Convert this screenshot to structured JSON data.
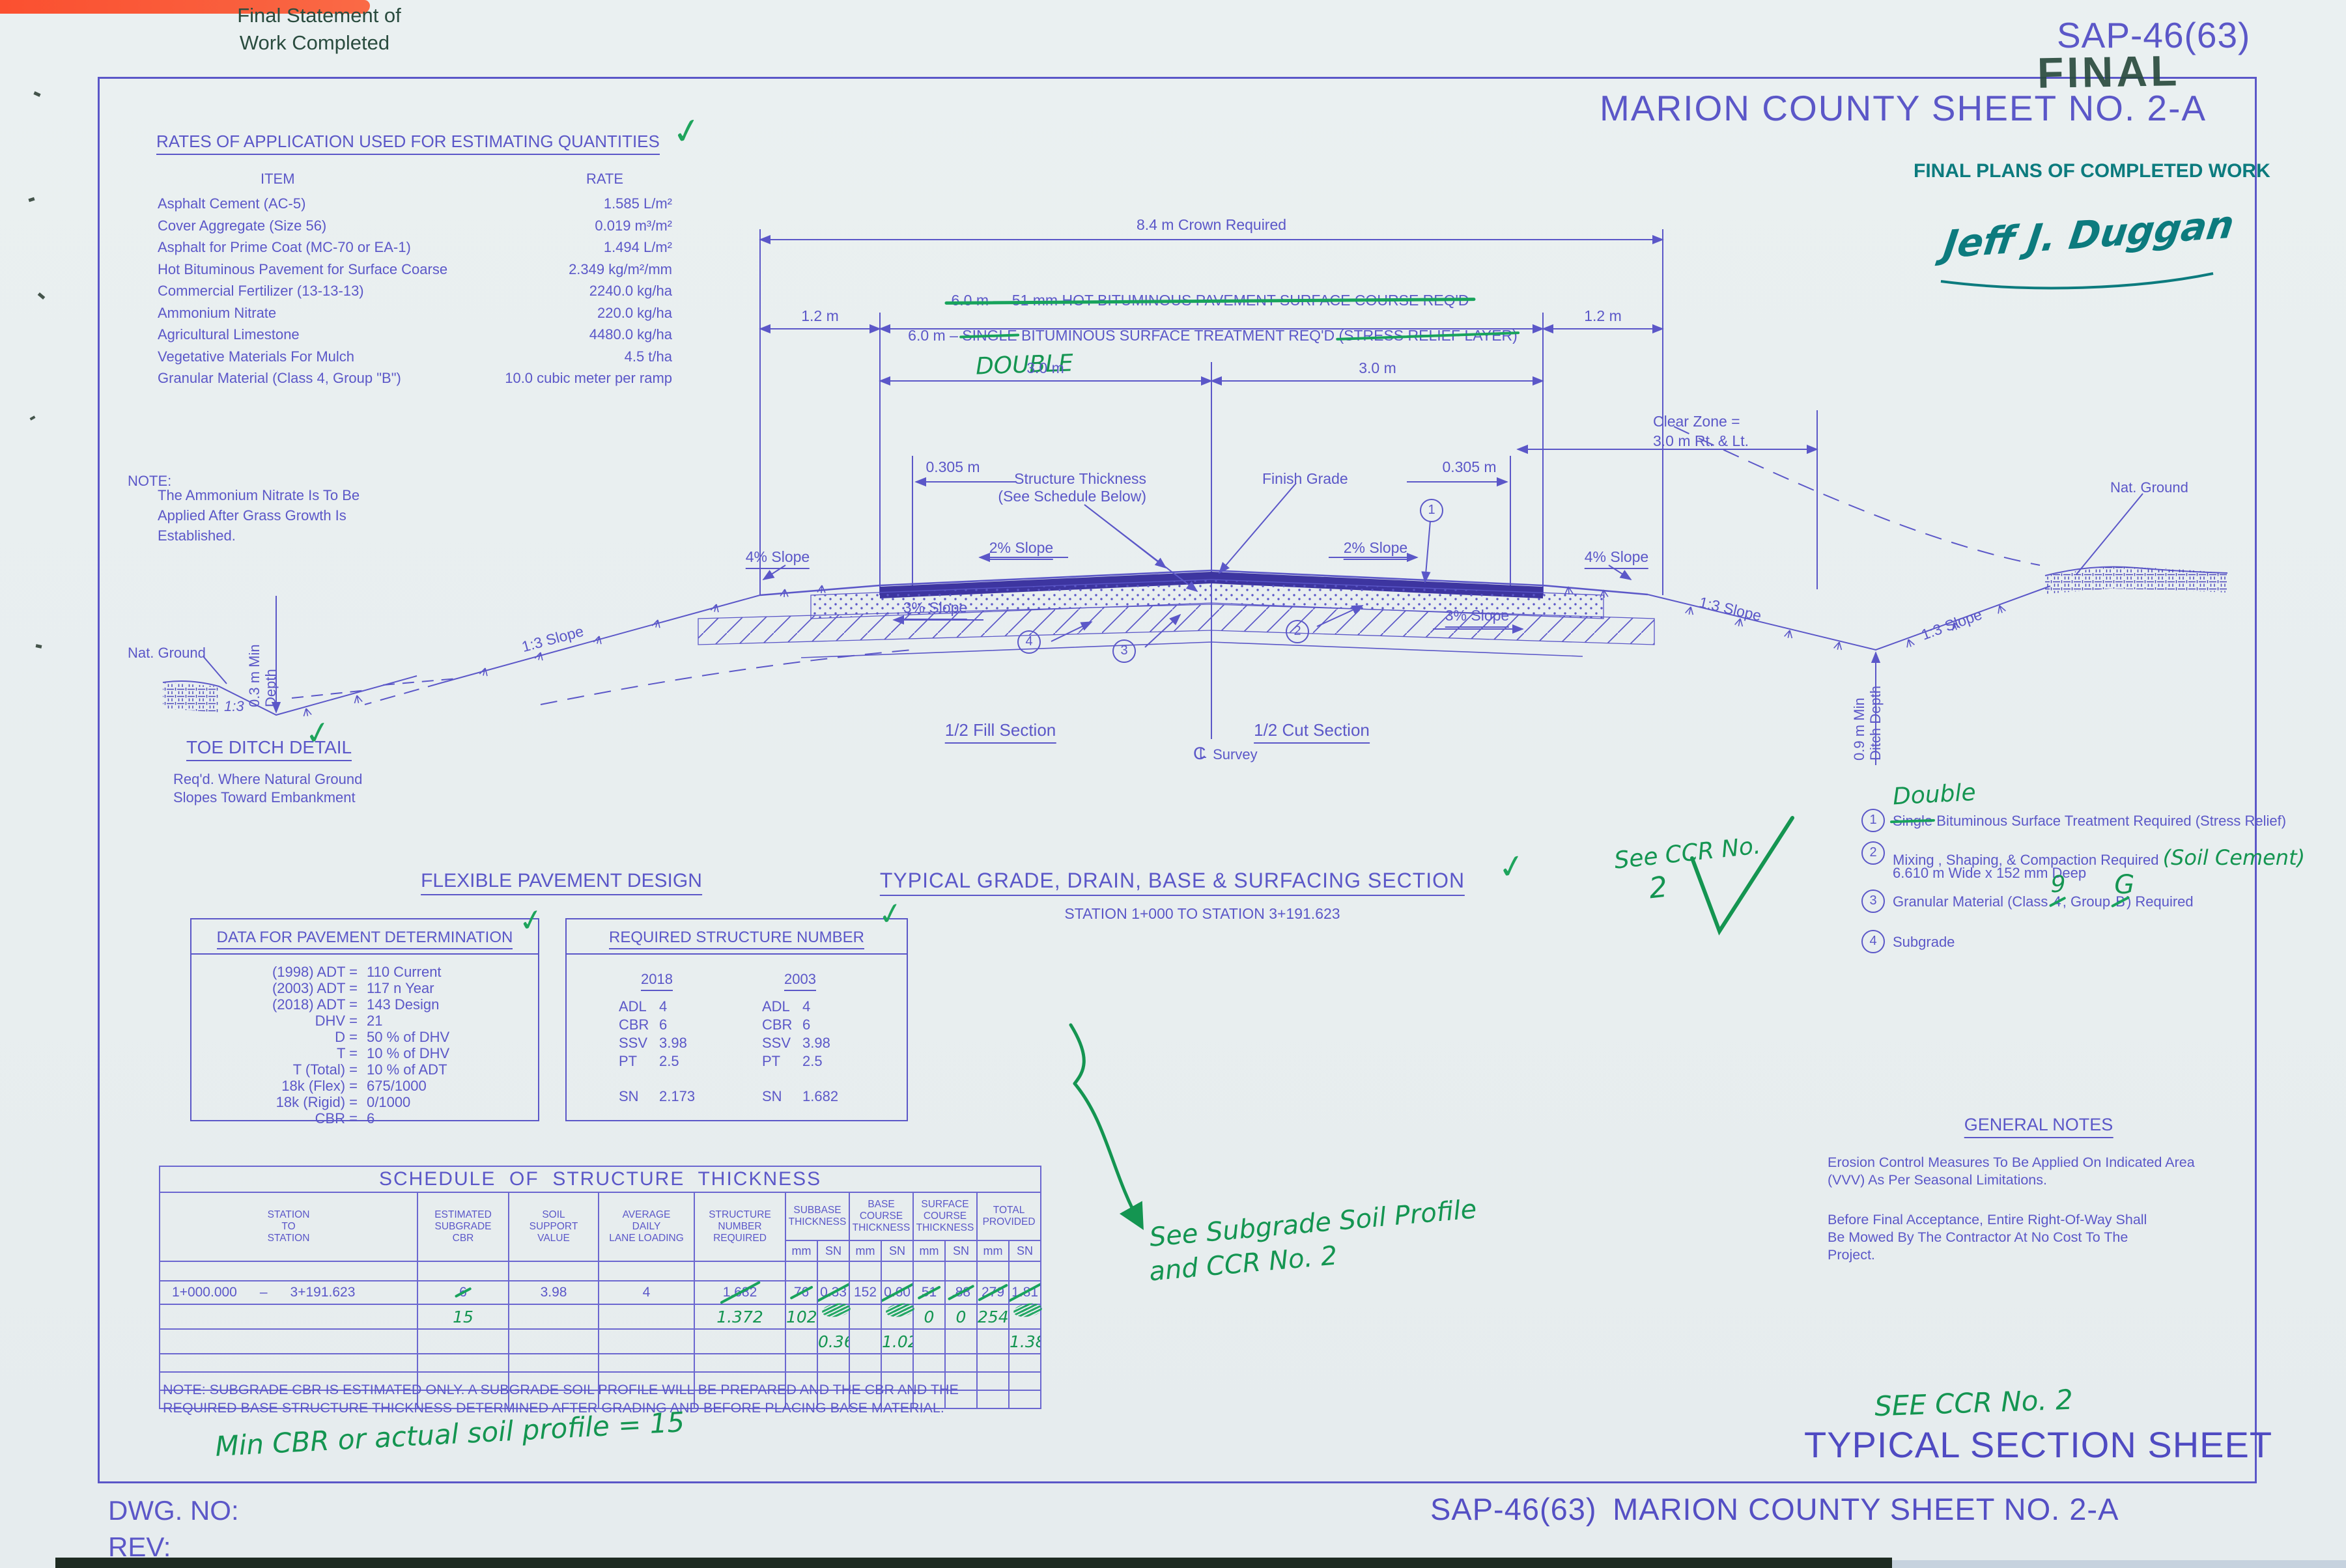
{
  "misc": {
    "check": "✓"
  },
  "header": {
    "stamp_line1": "Final Statement of",
    "stamp_line2": "Work Completed",
    "project_no": "SAP-46(63)",
    "final_stamp": "FINAL",
    "county_title": "MARION  COUNTY  SHEET NO. 2-A",
    "final_plans": "FINAL PLANS OF COMPLETED WORK",
    "signature": "Jeff J. Duggan"
  },
  "rates": {
    "heading": "RATES OF APPLICATION USED FOR ESTIMATING QUANTITIES",
    "col_item": "ITEM",
    "col_rate": "RATE",
    "rows": [
      {
        "item": "Asphalt Cement (AC-5)",
        "rate": "1.585 L/m²"
      },
      {
        "item": "Cover Aggregate (Size 56)",
        "rate": "0.019 m³/m²"
      },
      {
        "item": "Asphalt for Prime Coat (MC-70 or EA-1)",
        "rate": "1.494 L/m²"
      },
      {
        "item": "Hot Bituminous Pavement for Surface Coarse",
        "rate": "2.349 kg/m²/mm"
      },
      {
        "item": "Commercial Fertilizer (13-13-13)",
        "rate": "2240.0 kg/ha"
      },
      {
        "item": "Ammonium Nitrate",
        "rate": "220.0 kg/ha"
      },
      {
        "item": "Agricultural Limestone",
        "rate": "4480.0 kg/ha"
      },
      {
        "item": "Vegetative Materials For Mulch",
        "rate": "4.5 t/ha"
      },
      {
        "item": "Granular Material (Class 4, Group \"B\")",
        "rate": "10.0 cubic meter per ramp"
      }
    ]
  },
  "note": {
    "label": "NOTE:",
    "line1": "The Ammonium Nitrate Is To Be",
    "line2": "Applied After Grass Growth Is",
    "line3": "Established."
  },
  "toe": {
    "nat_ground": "Nat.  Ground",
    "ratio": "1:3",
    "depth1": "0.3 m  Min",
    "depth2": "Depth",
    "title": "TOE DITCH DETAIL",
    "cap1": "Req'd. Where Natural  Ground",
    "cap2": "Slopes Toward Embankment"
  },
  "sec": {
    "crown": "8.4 m Crown Required",
    "m12": "1.2 m",
    "hbp": "6.0 m  —  51 mm HOT BITUMINOUS PAVEMENT SURFACE COURSE REQ'D",
    "bst_pre": "6.0 m  –",
    "bst_single": "SINGLE",
    "bst_mid": "BITUMINOUS SURFACE TREATMENT REQ'D",
    "bst_stress": "(STRESS RELIEF LAYER)",
    "double": "DOUBLE",
    "m30": "3.0 m",
    "m0305": "0.305 m",
    "clear1": "Clear Zone =",
    "clear2": "3.0 m Rt. & Lt.",
    "st1": "Structure Thickness",
    "st2": "(See Schedule Below)",
    "finish": "Finish Grade",
    "s2": "2% Slope",
    "s4": "4% Slope",
    "s3": "3% Slope",
    "s13": "1:3 Slope",
    "natg": "Nat.  Ground",
    "dd1": "0.9 m  Min",
    "dd2": "Ditch Depth",
    "fill": "1/2  Fill  Section",
    "cut": "1/2  Cut Section",
    "cl_c": "C",
    "cl_l": "L",
    "survey": "Survey",
    "c1": "1",
    "c2": "2",
    "c3": "3",
    "c4": "4"
  },
  "title": {
    "main": "TYPICAL GRADE, DRAIN, BASE & SURFACING SECTION",
    "sub": "STATION 1+000 TO STATION 3+191.623"
  },
  "legend": {
    "double": "Double",
    "i1_n": "1",
    "i1_single": "Single",
    "i1_rest": "Bituminous Surface Treatment Required (Stress Relief)",
    "i2_n": "2",
    "i2_text": "Mixing , Shaping, & Compaction Required",
    "i2_hand": "(Soil Cement)",
    "i2_line2": "6.610 m Wide x 152 mm Deep",
    "i3_n": "3",
    "i3_pre": "Granular Material (Class ",
    "i3_4": "4",
    "i3_9": "9",
    "i3_mid": ", Group ",
    "i3_b": "B",
    "i3_g": "G",
    "i3_post": ") Required",
    "i4_n": "4",
    "i4_text": "Subgrade",
    "see_ccr1": "See CCR No.",
    "see_ccr2": "2"
  },
  "fpd": {
    "heading": "FLEXIBLE PAVEMENT DESIGN",
    "b1_title": "DATA FOR PAVEMENT DETERMINATION",
    "b1": [
      {
        "l": "(1998) ADT =",
        "v": "110 Current"
      },
      {
        "l": "(2003) ADT =",
        "v": "117 n Year"
      },
      {
        "l": "(2018) ADT =",
        "v": "143 Design"
      },
      {
        "l": "DHV =",
        "v": "21"
      },
      {
        "l": "D =",
        "v": "50 % of DHV"
      },
      {
        "l": "T =",
        "v": "10 % of DHV"
      },
      {
        "l": "T (Total) =",
        "v": "10 % of ADT"
      },
      {
        "l": "18k (Flex)  =",
        "v": "675/1000"
      },
      {
        "l": "18k (Rigid) =",
        "v": "0/1000"
      },
      {
        "l": "CBR =",
        "v": "6"
      }
    ],
    "b2_title": "REQUIRED STRUCTURE NUMBER",
    "y1": "2018",
    "y2": "2003",
    "rows": [
      {
        "k": "ADL",
        "a": "4",
        "b": "4"
      },
      {
        "k": "CBR",
        "a": "6",
        "b": "6"
      },
      {
        "k": "SSV",
        "a": "3.98",
        "b": "3.98"
      },
      {
        "k": "PT",
        "a": "2.5",
        "b": "2.5"
      }
    ],
    "sn": {
      "k": "SN",
      "a": "2.173",
      "b": "1.682"
    }
  },
  "sched": {
    "title": "SCHEDULE  OF  STRUCTURE  THICKNESS",
    "h_station": "STATION\nTO\nSTATION",
    "h_cbr": "ESTIMATED\nSUBGRADE\nCBR",
    "h_ssv": "SOIL\nSUPPORT\nVALUE",
    "h_adl": "AVERAGE\nDAILY\nLANE LOADING",
    "h_snr": "STRUCTURE\nNUMBER\nREQUIRED",
    "h_sub": "SUBBASE\nTHICKNESS",
    "h_base": "BASE\nCOURSE\nTHICKNESS",
    "h_surf": "SURFACE\nCOURSE\nTHICKNESS",
    "h_tot": "TOTAL\nPROVIDED",
    "mm": "mm",
    "sn": "SN",
    "row": {
      "station": "1+000.000      –      3+191.623",
      "cbr": "6",
      "ssv": "3.98",
      "adl": "4",
      "snr": "1.682",
      "sub_mm": "76",
      "sub_sn": "0.33",
      "base_mm": "152",
      "base_sn": "0.60",
      "surf_mm": "51",
      "surf_sn": ".88",
      "tot_mm": "279",
      "tot_sn": "1.81"
    },
    "hand": {
      "cbr": "15",
      "snr": "1.372",
      "sub_mm": "102",
      "surf_mm": "0",
      "surf_sn": "0",
      "tot_mm": "254",
      "sub_sn2": "0.36",
      "base_sn2": "1.02",
      "tot_sn2": "1.38"
    }
  },
  "sched_note": {
    "line1": "NOTE:   SUBGRADE CBR IS ESTIMATED ONLY.   A SUBGRADE SOIL PROFILE WILL BE PREPARED AND THE CBR AND THE",
    "line2": "REQUIRED BASE STRUCTURE THICKNESS DETERMINED AFTER GRADING AND BEFORE PLACING BASE MATERIAL."
  },
  "hand_notes": {
    "min_cbr": "Min CBR or actual soil profile = 15",
    "see_sub1": "See Subgrade Soil Profile",
    "see_sub2": "and CCR No. 2",
    "see_ccr_bottom": "SEE CCR No. 2"
  },
  "gnotes": {
    "heading": "GENERAL NOTES",
    "p1l1": "Erosion Control   Measures To Be Applied On Indicated Area",
    "p1l2": "(VVV) As Per Seasonal   Limitations.",
    "p2l1": "Before Final Acceptance,   Entire Right-Of-Way Shall",
    "p2l2": "Be Mowed By The Contractor At No Cost To The",
    "p2l3": "Project."
  },
  "footer": {
    "type_title": "TYPICAL SECTION SHEET",
    "bottom_proj": "SAP-46(63)",
    "bottom_county": "MARION COUNTY SHEET NO. 2-A",
    "dwg": "DWG. NO:",
    "rev": "REV:"
  }
}
